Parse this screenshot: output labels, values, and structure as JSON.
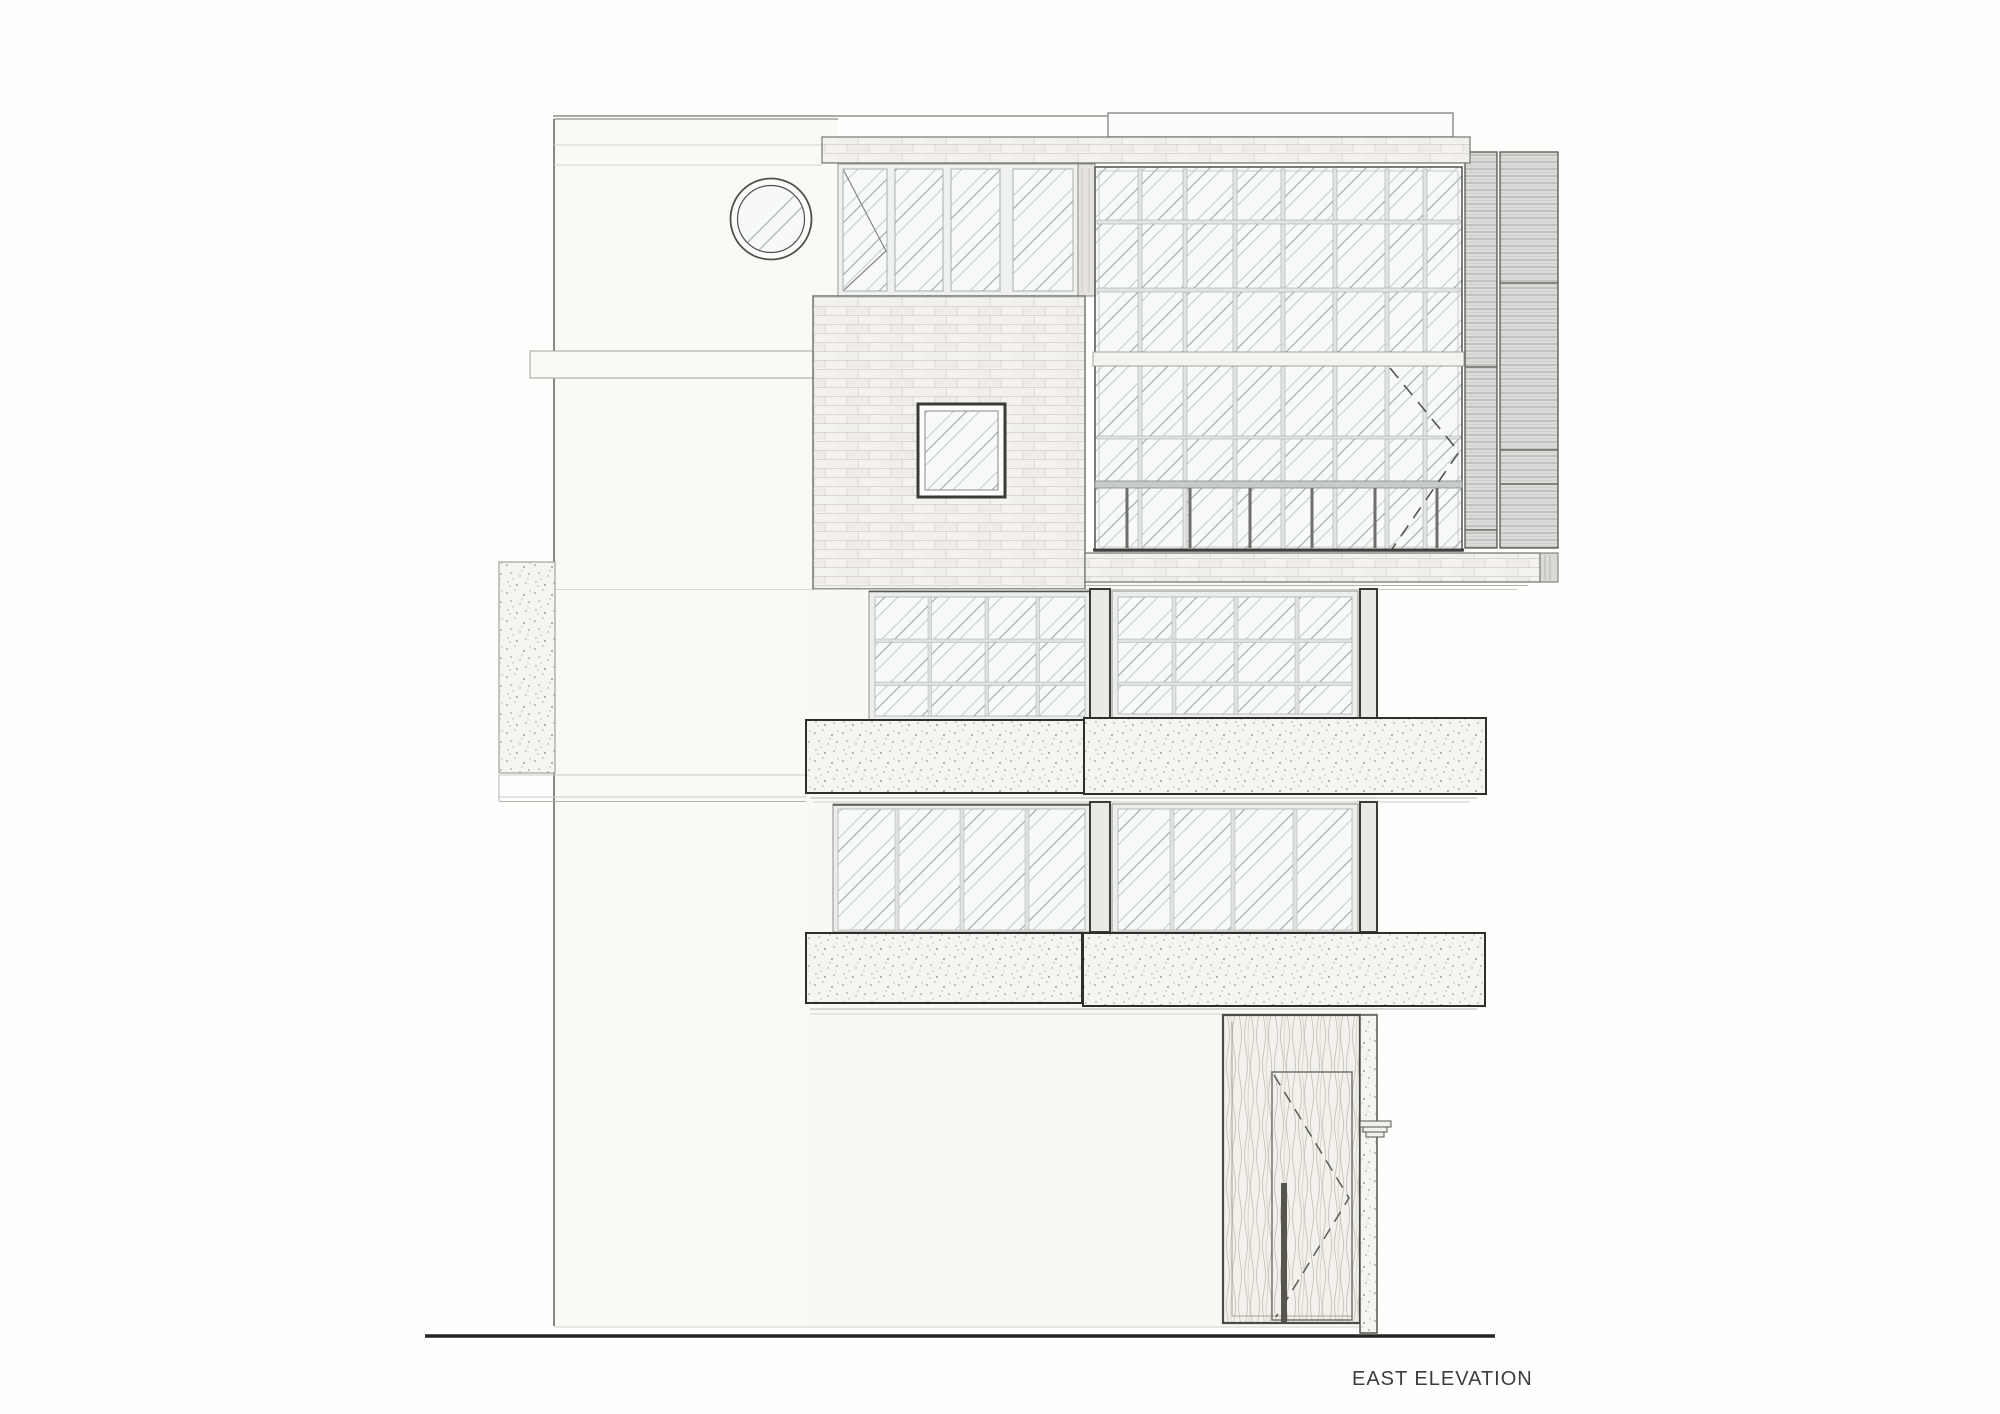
{
  "drawing": {
    "title": "EAST ELEVATION",
    "sheet": "architectural elevation drawing",
    "elements": {
      "circular_window": "round porthole window, upper left",
      "clerestory_windows": "four glazed panes below brick parapet",
      "curtain_wall": "large gridded glazing, upper right",
      "cladding": "corrugated metal panels, far right",
      "brick_wall": "brick panel with small square window",
      "balconies": "two stippled concrete balcony bands",
      "entry_door": "timber entry door with swing indication, lower right"
    },
    "colors": {
      "paper": "#fefefd",
      "ink_dark": "#3c3c3a",
      "ink_medium": "#6e6e6a",
      "line_light": "#cfcfcc",
      "glass_line": "#c5cccd",
      "glass_accent": "#a7b0b2",
      "mullion_fill": "#e2e5e3",
      "brick_joint": "#dad7d1",
      "corrugate_fill": "#dcdcda",
      "stipple_dot": "#9d9d97",
      "wood_grain": "#c4bfb4",
      "ground": "#262624"
    }
  }
}
